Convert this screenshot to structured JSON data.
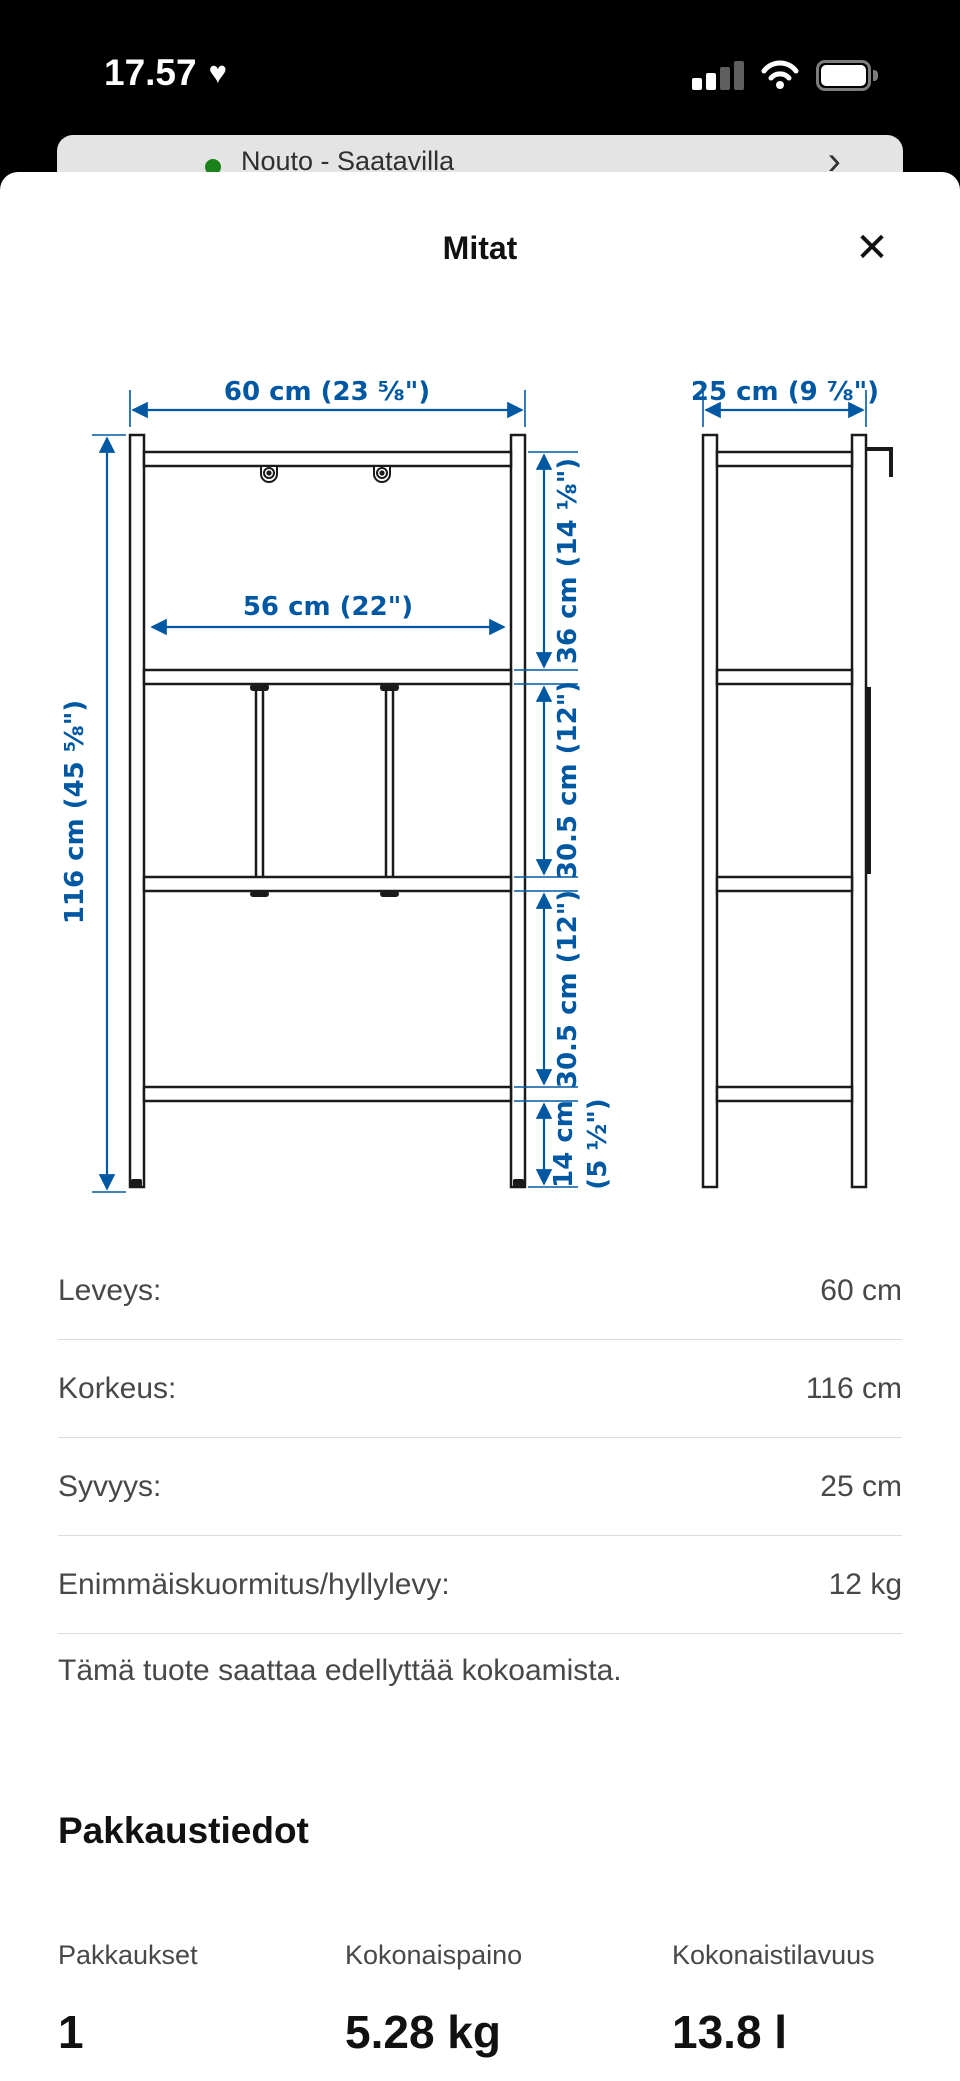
{
  "status_bar": {
    "time": "17.57",
    "heart_icon": "♥"
  },
  "background_sheet": {
    "label": "Nouto - Saatavilla",
    "chevron_icon": "›",
    "status_color": "#1a821a"
  },
  "modal": {
    "title": "Mitat",
    "close_icon": "✕"
  },
  "diagram": {
    "accent_color": "#0058a3",
    "front_view": {
      "width_label": "60 cm (23 ⅝\")",
      "inner_width_label": "56 cm (22\")",
      "height_label": "116 cm (45 ⅝\")",
      "top_section_label": "36 cm (14 ⅛\")",
      "middle_section_label": "30.5 cm (12\")",
      "lower_section_label": "30.5 cm (12\")",
      "bottom_section_label_line1": "14 cm",
      "bottom_section_label_line2": "(5 ½\")"
    },
    "side_view": {
      "depth_label": "25 cm (9 ⅞\")"
    }
  },
  "specs": {
    "rows": [
      {
        "label": "Leveys:",
        "value": "60 cm"
      },
      {
        "label": "Korkeus:",
        "value": "116 cm"
      },
      {
        "label": "Syvyys:",
        "value": "25 cm"
      },
      {
        "label": "Enimmäiskuormitus/hyllylevy:",
        "value": "12 kg"
      }
    ]
  },
  "assembly_note": "Tämä tuote saattaa edellyttää kokoamista.",
  "package_info": {
    "heading": "Pakkaustiedot",
    "columns": [
      {
        "label": "Pakkaukset",
        "value": "1"
      },
      {
        "label": "Kokonaispaino",
        "value": "5.28 kg"
      },
      {
        "label": "Kokonaistilavuus",
        "value": "13.8 l"
      }
    ]
  }
}
